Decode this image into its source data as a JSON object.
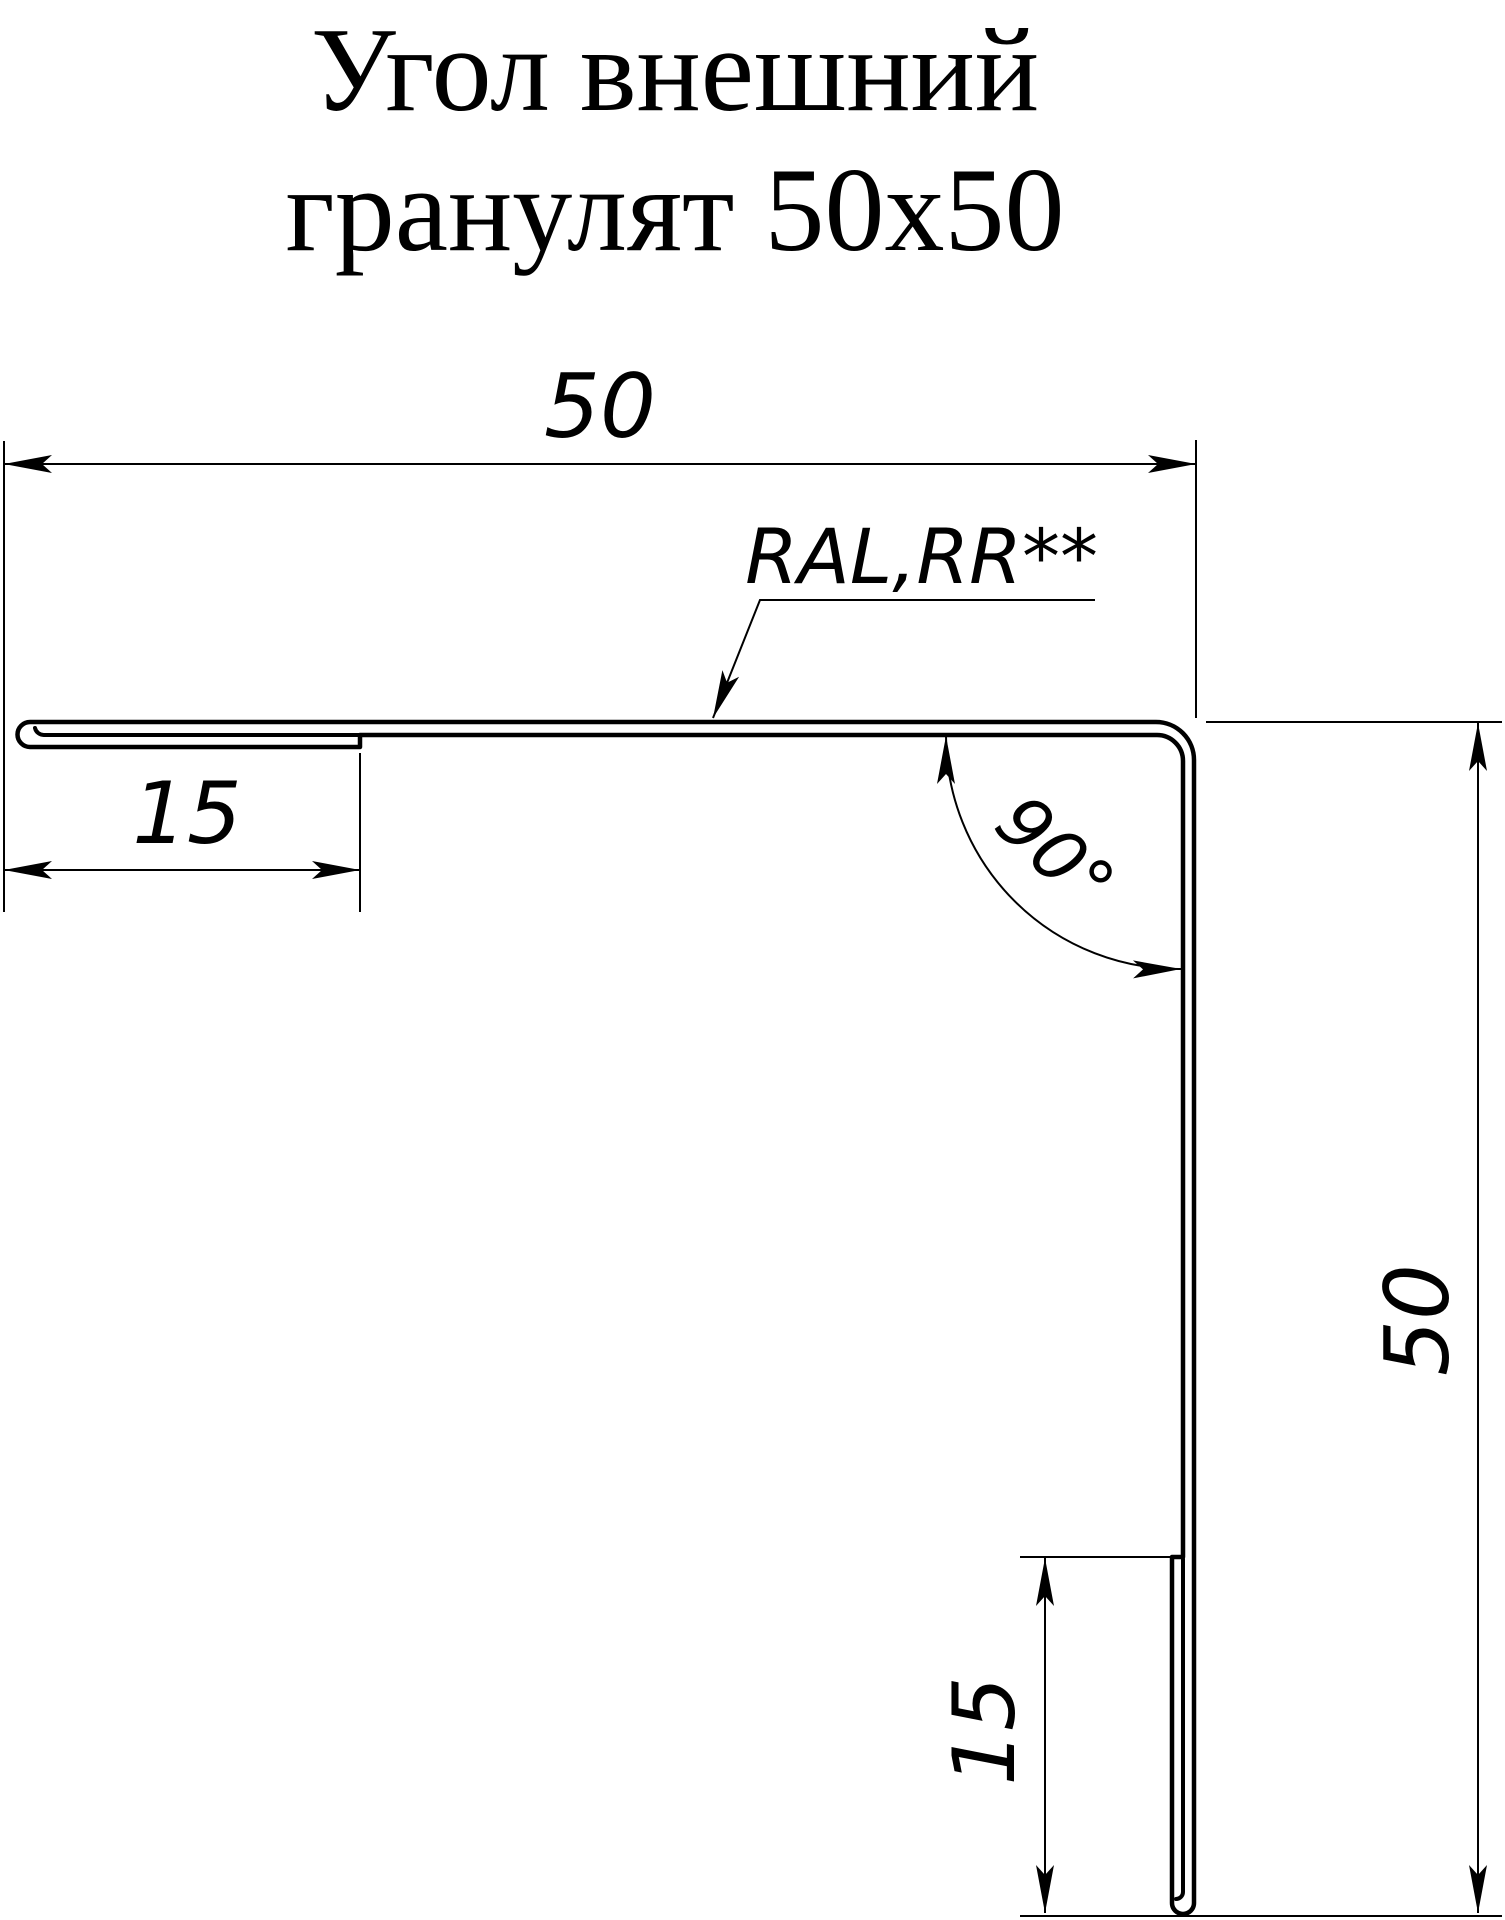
{
  "page": {
    "background_color": "#ffffff",
    "line_color": "#000000"
  },
  "title": {
    "line1": "Угол внешний",
    "line2": "гранулят 50x50"
  },
  "drawing": {
    "part": "outer-corner-profile",
    "material_label": "RAL,RR**",
    "dimensions": {
      "top_width": {
        "value": "50"
      },
      "left_hem": {
        "value": "15"
      },
      "right_height": {
        "value": "50"
      },
      "bottom_hem": {
        "value": "15"
      },
      "corner_angle": {
        "value": "90°"
      }
    }
  }
}
